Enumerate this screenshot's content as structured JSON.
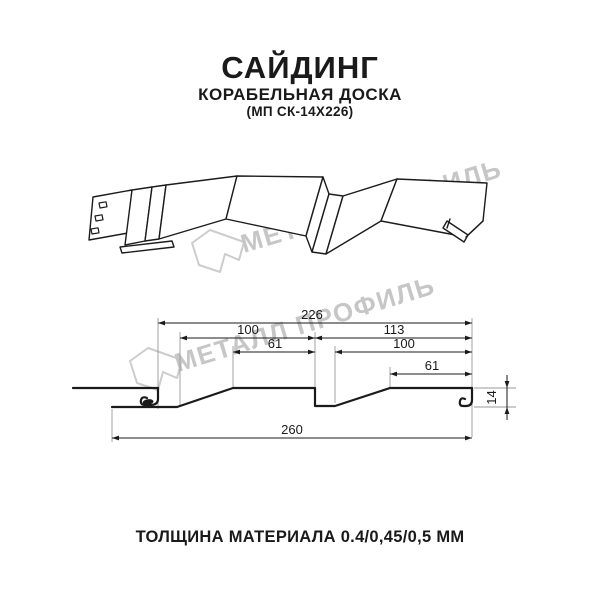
{
  "header": {
    "title": "САЙДИНГ",
    "subtitle": "КОРАБЕЛЬНАЯ ДОСКА",
    "code": "(МП СК-14Х226)"
  },
  "watermark": {
    "text": "МЕТАЛЛ ПРОФИЛЬ",
    "logo": "metall-profil-logo",
    "color": "#c6c6c6"
  },
  "footer": {
    "thickness_label": "ТОЛЩИНА МАТЕРИАЛА 0.4/0,45/0,5 ММ"
  },
  "colors": {
    "line": "#1a1a1a",
    "extension": "#9a9a9a"
  },
  "chart_data": {
    "type": "table",
    "title": "Размеры профиля сайдинг Корабельная доска МП СК-14Х226, мм",
    "dimensions_mm": {
      "module_width": 226,
      "board1_width": 100,
      "board1_flat": 61,
      "step_to_edge": 113,
      "board2_width": 100,
      "board2_flat": 61,
      "total_width": 260,
      "profile_height": 14
    }
  },
  "dimensions": {
    "unit": "mm",
    "horizontal": [
      {
        "label": "226",
        "x1": 158,
        "x2": 472,
        "y": 323,
        "label_x": 312
      },
      {
        "label": "100",
        "x1": 180,
        "x2": 315,
        "y": 338,
        "label_x": 248
      },
      {
        "label": "113",
        "x1": 315,
        "x2": 472,
        "y": 338,
        "label_x": 394
      },
      {
        "label": "61",
        "x1": 233,
        "x2": 315,
        "y": 352,
        "label_x": 275
      },
      {
        "label": "100",
        "x1": 335,
        "x2": 472,
        "y": 352,
        "label_x": 404
      },
      {
        "label": "61",
        "x1": 390,
        "x2": 472,
        "y": 374,
        "label_x": 432
      },
      {
        "label": "260",
        "x1": 112,
        "x2": 472,
        "y": 438,
        "label_x": 292
      }
    ],
    "vertical": [
      {
        "label": "14",
        "x": 507,
        "y1": 388,
        "y2": 407
      }
    ]
  }
}
